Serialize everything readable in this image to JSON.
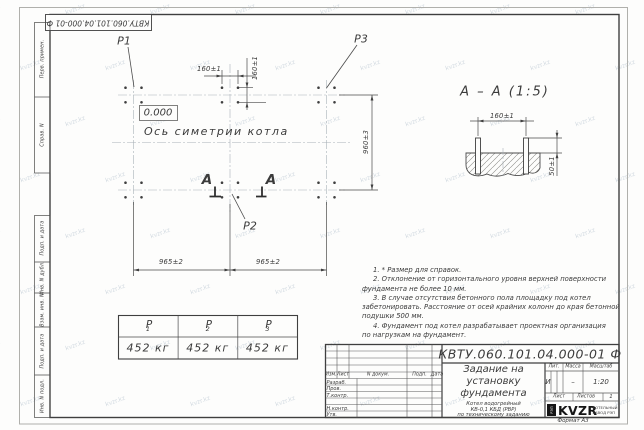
{
  "watermark": {
    "text": "kvzr.kz"
  },
  "corner_stamp": "КВТУ.060.101.04.000-01 Ф",
  "margin_fields": {
    "top": [
      "Перв. примен.",
      "Справ. N"
    ],
    "bottom": [
      "Подп. и дата",
      "Инв. N дубл.",
      "Взам. инв. N",
      "Подп. и дата",
      "Инв. N подл."
    ]
  },
  "plan": {
    "p1": "P1",
    "p2": "P2",
    "p3": "P3",
    "elevation": "0.000",
    "axis_label": "Ось симетрии котла",
    "dim_160_top": "160±1",
    "dim_160_side": "160±1",
    "dim_960": "960±3",
    "dim_965_left": "965±2",
    "dim_965_right": "965±2",
    "section_letter_left": "А",
    "section_letter_right": "А"
  },
  "section": {
    "title": "А – А (1:5)",
    "dim_160": "160±1",
    "dim_50": "50±1"
  },
  "notes": {
    "lines": [
      "1. * Размер для справок.",
      "2. Отклонение от горизонтального уровня верхней поверхности",
      "фундамента не более 10 мм.",
      "3. В случае отсутствия бетонного пола площадку под котел",
      "забетонировать. Расстояние от осей крайних колонн до края бетонной",
      "подушки 500 мм.",
      "4. Фундамент под котел разрабатывает проектная организация",
      "по нагрузкам на фундамент."
    ]
  },
  "load_table": {
    "headers": [
      {
        "base": "P",
        "sub": "1"
      },
      {
        "base": "P",
        "sub": "2"
      },
      {
        "base": "P",
        "sub": "3"
      }
    ],
    "values": [
      "452 кг",
      "452 кг",
      "452 кг"
    ]
  },
  "title_block": {
    "doc_number": "КВТУ.060.101.04.000-01 Ф",
    "title_line1": "Задание на",
    "title_line2": "установку",
    "title_line3": "фундамента",
    "subtitle_line1": "Котел водогрейный",
    "subtitle_line2": "КВ-0,1 КБД (РВР)",
    "subtitle_line3": "по техническому заданию",
    "header_row": [
      "Изм.",
      "Лист",
      "N докум.",
      "Подп.",
      "Дата"
    ],
    "row_labels": [
      "Разраб.",
      "Пров.",
      "Т.контр.",
      "",
      "Н.контр.",
      "Утв."
    ],
    "lit_header": "Лит.",
    "mass_header": "Масса",
    "scale_header": "Масштаб",
    "lit_value": "И",
    "mass_value": "–",
    "scale_value": "1:20",
    "sheet_label": "Лист",
    "sheets_label": "Листов",
    "sheets_value": "1",
    "logo_text": "KVZR",
    "logo_sub1": "КОТЕЛЬНЫЙ",
    "logo_sub2": "ЗАВОД РЭП",
    "logo_emblem": "РЭП",
    "format_label": "Формат А3"
  }
}
